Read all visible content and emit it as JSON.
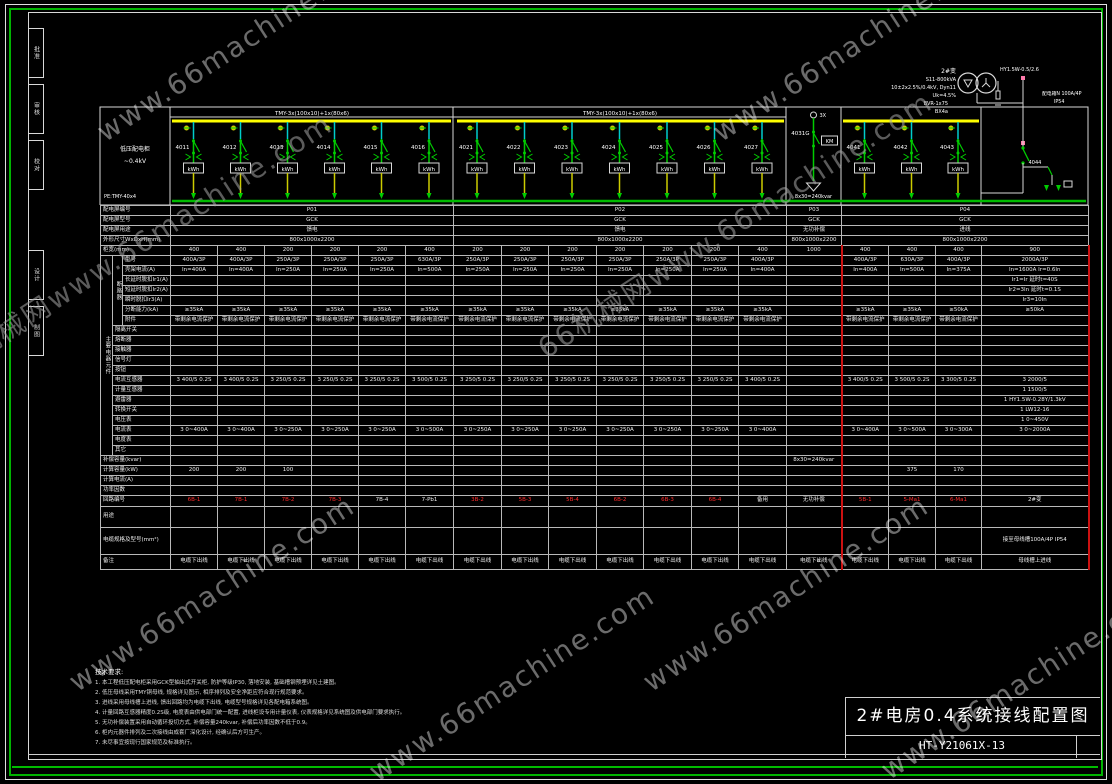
{
  "frame": {
    "strip": [
      {
        "t": "批准",
        "y": 28
      },
      {
        "t": "审核",
        "y": 84
      },
      {
        "t": "校对",
        "y": 140
      },
      {
        "t": "设计",
        "y": 250
      },
      {
        "t": "制图",
        "y": 306
      }
    ]
  },
  "watermarks": [
    {
      "t": "www.66machine.com",
      "x": 100,
      "y": 118,
      "g": 0
    },
    {
      "t": "www.66machine.com",
      "x": 716,
      "y": 118,
      "g": 0
    },
    {
      "t": "66机械网www.66machine.com",
      "x": -60,
      "y": 352,
      "g": 1
    },
    {
      "t": "66机械网www.66machine.com",
      "x": 540,
      "y": 330,
      "g": 1
    },
    {
      "t": "www.66machine.com",
      "x": 72,
      "y": 668,
      "g": 0
    },
    {
      "t": "www.66machine.com",
      "x": 372,
      "y": 758,
      "g": 0
    },
    {
      "t": "www.66machine.com",
      "x": 646,
      "y": 668,
      "g": 0
    },
    {
      "t": "www.66machine.com",
      "x": 884,
      "y": 756,
      "g": 0
    }
  ],
  "schematic": {
    "bus_label": "TMY-3x(100x10)+1x(80x6)",
    "pe_label": "PE:TMY-40x4",
    "left_block_l1": "低压配电柜",
    "left_block_l2": "~0.4kV",
    "meter": "kWh",
    "circuit_ids": [
      "4011",
      "4012",
      "4013",
      "4014",
      "4015",
      "4016",
      "4021",
      "4022",
      "4023",
      "4024",
      "4025",
      "4026",
      "4027",
      "4031G",
      "4041",
      "4042",
      "4043"
    ],
    "comp": {
      "top": "3X",
      "box": "KM",
      "kvar": "8x30=240kvar"
    },
    "transformer": {
      "name": "2#变",
      "l1": "S11-800kVA",
      "l2": "10±2x2.5%/0.4kV, Dyn11",
      "l3": "Uk=4.5%",
      "arrester": "HY1.5W-0.5/2.6",
      "c1": "BVR-1x75",
      "c2": "BX4a",
      "branch": "4044",
      "box": "配电箱N 100A/4P",
      "ip": "IP54"
    }
  },
  "table": {
    "col_w": [
      47,
      47,
      47,
      47,
      47,
      48,
      48,
      47,
      48,
      47,
      48,
      47,
      48,
      55,
      47,
      47,
      46,
      107
    ],
    "groups": [
      {
        "label": "主要电器元件",
        "from": 5,
        "to": 24
      },
      {
        "label": "断路器",
        "from": 5,
        "to": 11
      }
    ],
    "rows": [
      {
        "label": "配电屏编号",
        "h": 9,
        "spans": [
          {
            "n": 6,
            "t": "P01"
          },
          {
            "n": 7,
            "t": "P02"
          },
          {
            "n": 1,
            "t": "P03"
          },
          {
            "n": 4,
            "t": "P04"
          }
        ]
      },
      {
        "label": "配电屏型号",
        "h": 9,
        "spans": [
          {
            "n": 6,
            "t": "GCK"
          },
          {
            "n": 7,
            "t": "GCK"
          },
          {
            "n": 1,
            "t": "GCK"
          },
          {
            "n": 4,
            "t": "GCK"
          }
        ]
      },
      {
        "label": "配电屏用途",
        "h": 9,
        "spans": [
          {
            "n": 6,
            "t": "馈电"
          },
          {
            "n": 7,
            "t": "馈电"
          },
          {
            "n": 1,
            "t": "无功补偿"
          },
          {
            "n": 4,
            "t": "进线"
          }
        ]
      },
      {
        "label": "外形尺寸WxDxH(mm)",
        "h": 9,
        "spans": [
          {
            "n": 6,
            "t": "800x1000x2200"
          },
          {
            "n": 7,
            "t": "800x1000x2200"
          },
          {
            "n": 1,
            "t": "800x1000x2200"
          },
          {
            "n": 4,
            "t": "800x1000x2200"
          }
        ]
      },
      {
        "label": "柜宽(mm)",
        "h": 9,
        "cells": [
          "400",
          "400",
          "200",
          "200",
          "200",
          "400",
          "200",
          "200",
          "200",
          "200",
          "200",
          "200",
          "400",
          "1000",
          "400",
          "400",
          "400",
          "900"
        ]
      },
      {
        "label": "型号",
        "h": 9,
        "cells": [
          "400A/3P",
          "400A/3P",
          "250A/3P",
          "250A/3P",
          "250A/3P",
          "630A/3P",
          "250A/3P",
          "250A/3P",
          "250A/3P",
          "250A/3P",
          "250A/3P",
          "250A/3P",
          "400A/3P",
          "",
          "400A/3P",
          "630A/3P",
          "400A/3P",
          "2000A/3P"
        ]
      },
      {
        "label": "壳架电流(A)",
        "h": 9,
        "cells": [
          "In=400A",
          "In=400A",
          "In=250A",
          "In=250A",
          "In=250A",
          "In=500A",
          "In=250A",
          "In=250A",
          "In=250A",
          "In=250A",
          "In=250A",
          "In=250A",
          "In=400A",
          "",
          "In=400A",
          "In=500A",
          "In=375A",
          "In=1600A Ir=0.6In"
        ]
      },
      {
        "label": "长延时脱扣Ir1(A)",
        "h": 9,
        "cells": [
          "",
          "",
          "",
          "",
          "",
          "",
          "",
          "",
          "",
          "",
          "",
          "",
          "",
          "",
          "",
          "",
          "",
          "Ir1=Ir 延时t=40S"
        ]
      },
      {
        "label": "短延时脱扣Ir2(A)",
        "h": 9,
        "cells": [
          "",
          "",
          "",
          "",
          "",
          "",
          "",
          "",
          "",
          "",
          "",
          "",
          "",
          "",
          "",
          "",
          "",
          "Ir2=3In 延时t=0.1S"
        ]
      },
      {
        "label": "瞬时脱扣Ir3(A)",
        "h": 9,
        "cells": [
          "",
          "",
          "",
          "",
          "",
          "",
          "",
          "",
          "",
          "",
          "",
          "",
          "",
          "",
          "",
          "",
          "",
          "Ir3=10In"
        ]
      },
      {
        "label": "分断能力(kA)",
        "h": 9,
        "cells": [
          "≥35kA",
          "≥35kA",
          "≥35kA",
          "≥35kA",
          "≥35kA",
          "≥35kA",
          "≥35kA",
          "≥35kA",
          "≥35kA",
          "≥35kA",
          "≥35kA",
          "≥35kA",
          "≥35kA",
          "",
          "≥35kA",
          "≥35kA",
          "≥50kA",
          "≥50kA"
        ]
      },
      {
        "label": "附件",
        "h": 9,
        "cells": [
          "带剩余电流保护",
          "带剩余电流保护",
          "带剩余电流保护",
          "带剩余电流保护",
          "带剩余电流保护",
          "带剩余电流保护",
          "带剩余电流保护",
          "带剩余电流保护",
          "带剩余电流保护",
          "带剩余电流保护",
          "带剩余电流保护",
          "带剩余电流保护",
          "带剩余电流保护",
          "",
          "带剩余电流保护",
          "带剩余电流保护",
          "带剩余电流保护",
          ""
        ]
      },
      {
        "label": "隔离开关",
        "h": 9
      },
      {
        "label": "熔断器",
        "h": 9
      },
      {
        "label": "接触器",
        "h": 9
      },
      {
        "label": "信号灯",
        "h": 9
      },
      {
        "label": "按钮",
        "h": 9
      },
      {
        "label": "电流互感器",
        "h": 9,
        "cells": [
          "3 400/5 0.2S",
          "3 400/5 0.2S",
          "3 250/5 0.2S",
          "3 250/5 0.2S",
          "3 250/5 0.2S",
          "3 500/5 0.2S",
          "3 250/5 0.2S",
          "3 250/5 0.2S",
          "3 250/5 0.2S",
          "3 250/5 0.2S",
          "3 250/5 0.2S",
          "3 250/5 0.2S",
          "3 400/5 0.2S",
          "",
          "3 400/5 0.2S",
          "3 500/5 0.2S",
          "3 300/5 0.2S",
          "3 2000/5"
        ]
      },
      {
        "label": "计量互感器",
        "h": 9,
        "cells": [
          "",
          "",
          "",
          "",
          "",
          "",
          "",
          "",
          "",
          "",
          "",
          "",
          "",
          "",
          "",
          "",
          "",
          "1 1500/5"
        ]
      },
      {
        "label": "避雷器",
        "h": 9,
        "cells": [
          "",
          "",
          "",
          "",
          "",
          "",
          "",
          "",
          "",
          "",
          "",
          "",
          "",
          "",
          "",
          "",
          "",
          "1 HY1.5W-0.28Y/1.3kV"
        ]
      },
      {
        "label": "转换开关",
        "h": 9,
        "cells": [
          "",
          "",
          "",
          "",
          "",
          "",
          "",
          "",
          "",
          "",
          "",
          "",
          "",
          "",
          "",
          "",
          "",
          "1 LW12-16"
        ]
      },
      {
        "label": "电压表",
        "h": 9,
        "cells": [
          "",
          "",
          "",
          "",
          "",
          "",
          "",
          "",
          "",
          "",
          "",
          "",
          "",
          "",
          "",
          "",
          "",
          "1 0~450V"
        ]
      },
      {
        "label": "电流表",
        "h": 9,
        "cells": [
          "3 0~400A",
          "3 0~400A",
          "3 0~250A",
          "3 0~250A",
          "3 0~250A",
          "3 0~500A",
          "3 0~250A",
          "3 0~250A",
          "3 0~250A",
          "3 0~250A",
          "3 0~250A",
          "3 0~250A",
          "3 0~400A",
          "",
          "3 0~400A",
          "3 0~500A",
          "3 0~300A",
          "3 0~2000A"
        ]
      },
      {
        "label": "电度表",
        "h": 9
      },
      {
        "label": "其它",
        "h": 9
      },
      {
        "label": "补偿容量(kvar)",
        "h": 9,
        "cells": [
          "",
          "",
          "",
          "",
          "",
          "",
          "",
          "",
          "",
          "",
          "",
          "",
          "",
          "8x30=240kvar",
          "",
          "",
          "",
          ""
        ]
      },
      {
        "label": "计算容量(kW)",
        "h": 9,
        "cells": [
          "200",
          "200",
          "100",
          "",
          "",
          "",
          "",
          "",
          "",
          "",
          "",
          "",
          "",
          "",
          "",
          "375",
          "170",
          ""
        ]
      },
      {
        "label": "计算电流(A)",
        "h": 9
      },
      {
        "label": "功率因数",
        "h": 9
      },
      {
        "label": "回路编号",
        "h": 10,
        "cells": [
          {
            "t": "6B-1",
            "c": "r"
          },
          {
            "t": "7B-1",
            "c": "r"
          },
          {
            "t": "7B-2",
            "c": "r"
          },
          {
            "t": "7B-3",
            "c": "r"
          },
          "7B-4",
          "7-Pb1",
          {
            "t": "3B-2",
            "c": "r"
          },
          {
            "t": "5B-3",
            "c": "r"
          },
          {
            "t": "5B-4",
            "c": "r"
          },
          {
            "t": "6B-2",
            "c": "r"
          },
          {
            "t": "6B-3",
            "c": "r"
          },
          {
            "t": "6B-4",
            "c": "r"
          },
          "备用",
          "无功补偿",
          {
            "t": "5B-1",
            "c": "r"
          },
          {
            "t": "5-Ma1",
            "c": "r"
          },
          {
            "t": "6-Ma1",
            "c": "r"
          },
          "2#变"
        ]
      },
      {
        "label": "用途",
        "h": 20
      },
      {
        "label": "电缆规格及型号(mm²)",
        "h": 26,
        "cells": [
          "",
          "",
          "",
          "",
          "",
          "",
          "",
          "",
          "",
          "",
          "",
          "",
          "",
          "",
          "",
          "",
          "",
          {
            "t": "接至母线槽100A/4P IP54",
            "w": 1
          }
        ]
      },
      {
        "label": "备注",
        "h": 14,
        "cells": [
          "电缆下出线",
          "电缆下出线",
          "电缆下出线",
          "电缆下出线",
          "电缆下出线",
          "电缆下出线",
          "电缆下出线",
          "电缆下出线",
          "电缆下出线",
          "电缆下出线",
          "电缆下出线",
          "电缆下出线",
          "电缆下出线",
          "电缆下出线",
          "电缆下出线",
          "电缆下出线",
          "电缆下出线",
          "母线槽上进线"
        ]
      }
    ]
  },
  "notes": {
    "title": "技术要求:",
    "items": [
      "1. 本工程低压配电柜采用GCK型抽出式开关柜, 防护等级IP30, 落地安装, 基础槽钢预埋详见土建图。",
      "2. 低压母线采用TMY铜母线, 规格详见图示, 相序排列及安全净距应符合现行规范要求。",
      "3. 进线采用母线槽上进线, 馈出回路均为电缆下出线, 电缆型号规格详见各配电箱系统图。",
      "4. 计量回路互感器精度0.2S级, 电度表由供电部门统一配置, 进线柜设专用计量仪表, 仪表规格详见系统图及供电部门要求执行。",
      "5. 无功补偿装置采用自动循环投切方式, 补偿容量240kvar, 补偿后功率因数不低于0.9。",
      "6. 柜内元器件排列及二次接线由成套厂深化设计, 经确认后方可生产。",
      "7. 未尽事宜按现行国家规范及标准执行。"
    ]
  },
  "title_block": {
    "title": "2#电房0.4系统接线配置图",
    "number": "HT-Y21061X-13"
  },
  "colors": {
    "bus": "#ffff00",
    "feeder_green": "#00cc00",
    "pe": "#00bb00",
    "cyan": "#00cccc",
    "red": "#ff2b2b",
    "pink": "#ff7bac"
  }
}
